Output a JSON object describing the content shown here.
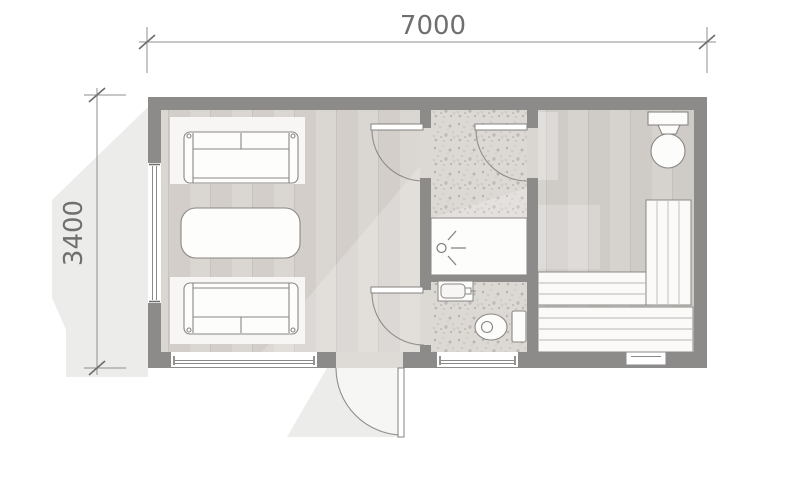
{
  "drawing": {
    "dimensions": {
      "width_label": "7000",
      "height_label": "3400"
    },
    "colors": {
      "background": "#ffffff",
      "wall": "#8d8b89",
      "floor_wood": "#d8d4cf",
      "floor_terrazzo": "#dcd9d5",
      "floor_sauna": "#d4d1cc",
      "fixture_fill": "#fcfcfb",
      "fixture_outline": "#8a8683",
      "dimension_line": "#8f8f8f",
      "dimension_text": "#6f6f6f",
      "shadow": "#ececea"
    }
  }
}
